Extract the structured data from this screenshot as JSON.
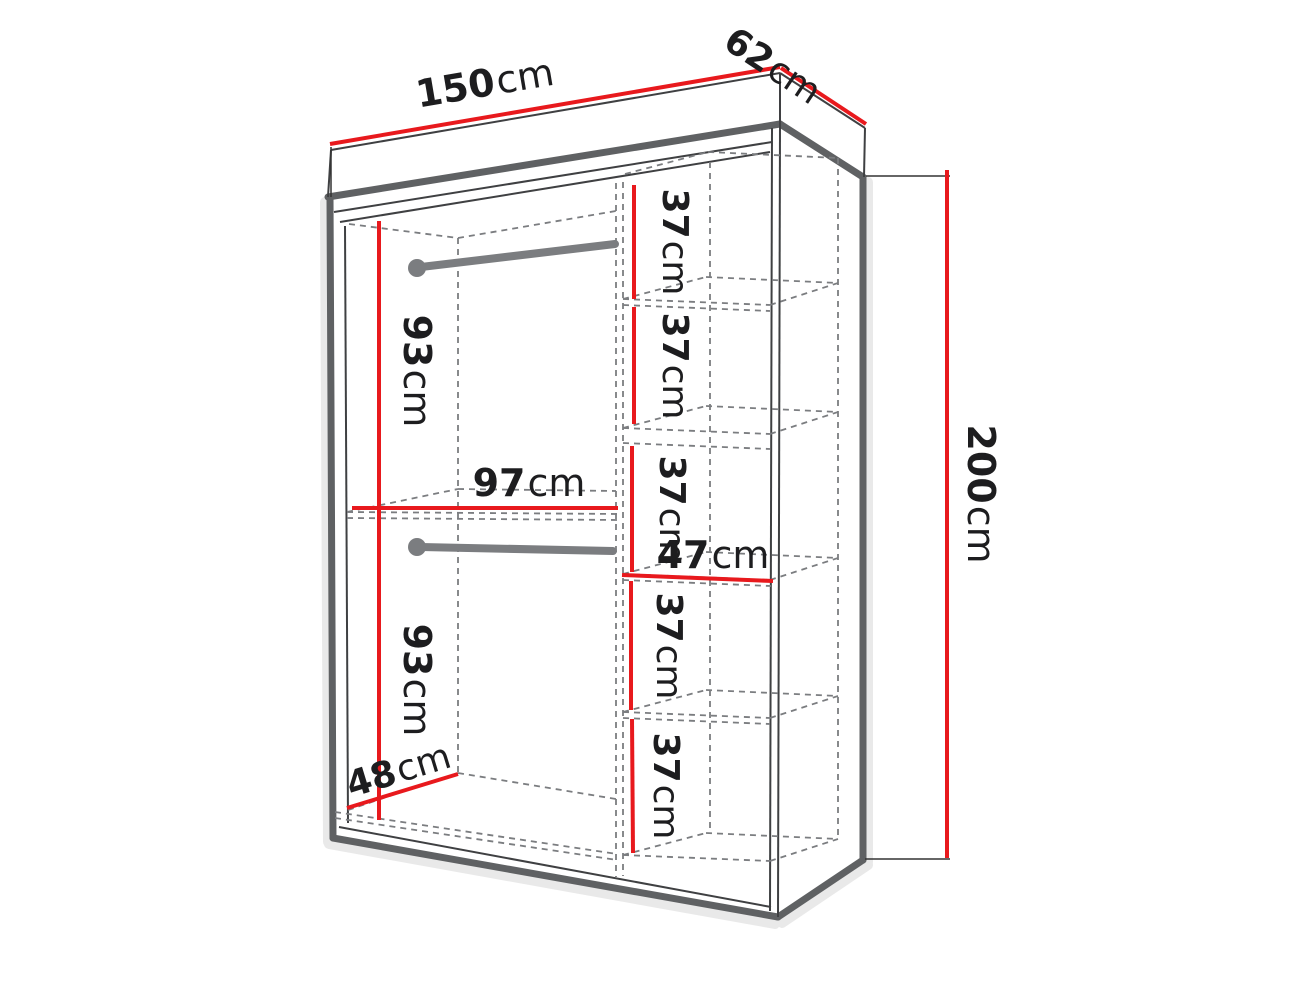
{
  "diagram": {
    "subject": "wardrobe-dimension-diagram",
    "unit": "cm"
  },
  "colors": {
    "dimension_red": "#e8191d",
    "edge_thick": "#5f6163",
    "edge_thin": "#3f4042",
    "extension_line": "#333333",
    "hidden_dashed": "#7b7d80",
    "rail_gray": "#7b7d80",
    "shadow": "#c4c4c4",
    "label_text": "#1d1d1f",
    "background": "#ffffff"
  },
  "dimensions": {
    "width": {
      "num": "150",
      "unit": "cm"
    },
    "depth": {
      "num": "62",
      "unit": "cm"
    },
    "height": {
      "num": "200",
      "unit": "cm"
    },
    "hanging_upper_height": {
      "num": "93",
      "unit": "cm"
    },
    "hanging_lower_height": {
      "num": "93",
      "unit": "cm"
    },
    "left_section_width": {
      "num": "97",
      "unit": "cm"
    },
    "shelf_section_width": {
      "num": "47",
      "unit": "cm"
    },
    "interior_depth": {
      "num": "48",
      "unit": "cm"
    },
    "shelf_spacings": [
      {
        "num": "37",
        "unit": "cm"
      },
      {
        "num": "37",
        "unit": "cm"
      },
      {
        "num": "37",
        "unit": "cm"
      },
      {
        "num": "37",
        "unit": "cm"
      },
      {
        "num": "37",
        "unit": "cm"
      }
    ]
  }
}
